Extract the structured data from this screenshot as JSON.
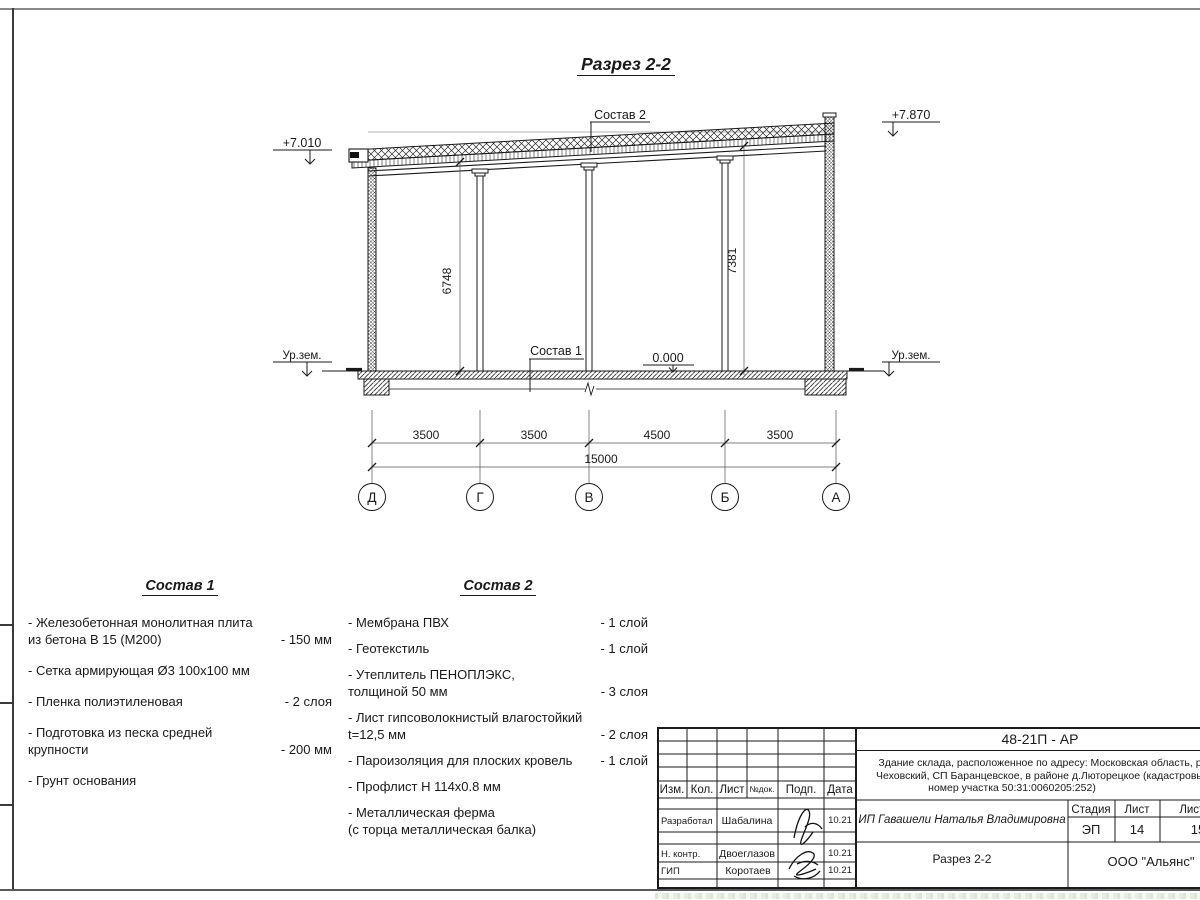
{
  "drawing": {
    "title": "Разрез 2-2",
    "labels": {
      "sostav1": "Состав 1",
      "sostav2": "Состав 2",
      "elev_left": "+7.010",
      "elev_right": "+7.870",
      "elev_zero": "0.000",
      "ground_left": "Ур.зем.",
      "ground_right": "Ур.зем."
    },
    "dims": {
      "height_left": "6748",
      "height_right": "7381",
      "spans": [
        "3500",
        "3500",
        "4500",
        "3500"
      ],
      "total": "15000"
    },
    "axes": [
      "Д",
      "Г",
      "В",
      "Б",
      "А"
    ]
  },
  "sostav1": {
    "title": "Состав 1",
    "items": [
      {
        "name": "- Железобетонная  монолитная плита\nиз бетона В 15 (М200)",
        "value": "- 150 мм"
      },
      {
        "name": "- Сетка армирующая Ø3 100х100 мм",
        "value": ""
      },
      {
        "name": "- Пленка полиэтиленовая",
        "value": "-  2 слоя"
      },
      {
        "name": "- Подготовка из песка средней\nкрупности",
        "value": "- 200 мм"
      },
      {
        "name": "- Грунт основания",
        "value": ""
      }
    ]
  },
  "sostav2": {
    "title": "Состав 2",
    "items": [
      {
        "name": "- Мембрана ПВХ",
        "value": "- 1 слой"
      },
      {
        "name": "- Геотекстиль",
        "value": "- 1 слой"
      },
      {
        "name": "- Утеплитель ПЕНОПЛЭКС,\nтолщиной 50 мм",
        "value": "- 3 слоя"
      },
      {
        "name": "- Лист гипсоволокнистый влагостойкий\nt=12,5 мм",
        "value": "- 2 слоя"
      },
      {
        "name": "- Пароизоляция для плоских кровель",
        "value": "- 1 слой"
      },
      {
        "name": "- Профлист Н 114х0.8 мм",
        "value": ""
      },
      {
        "name": "- Металлическая ферма\n(с торца металлическая балка)",
        "value": ""
      }
    ]
  },
  "titleblock": {
    "doc_code": "48-21П - АР",
    "address_line1": "Здание склада, расположенное по адресу: Московская область, р",
    "address_line2": "Чеховский, СП Баранцевское, в районе д.Люторецкое  (кадастровы",
    "address_line3": "номер участка 50:31:0060205:252)",
    "client": "ИП Гавашели Наталья Владимировна",
    "sheet_title": "Разрез 2-2",
    "company": "ООО \"Альянс\"",
    "stage_label": "Стадия",
    "sheet_label": "Лист",
    "sheets_label": "Листов",
    "stage_value": "ЭП",
    "sheet_value": "14",
    "sheets_value": "15",
    "cols": {
      "izm": "Изм.",
      "kol": "Кол.",
      "list": "Лист",
      "ndoc": "№док.",
      "podp": "Подп.",
      "data": "Дата"
    },
    "rows": [
      {
        "role": "Разработал",
        "name": "Шабалина",
        "date": "10.21"
      },
      {
        "role": "Н. контр.",
        "name": "Двоеглазов",
        "date": "10.21"
      },
      {
        "role": "ГИП",
        "name": "Коротаев",
        "date": "10.21"
      }
    ]
  }
}
